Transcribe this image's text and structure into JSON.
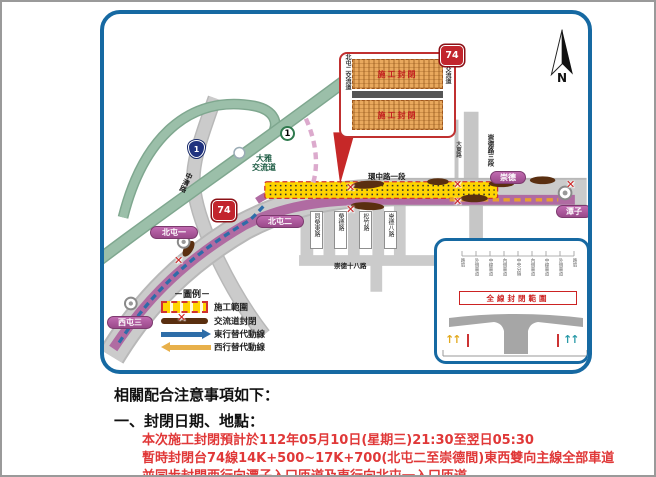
{
  "map": {
    "compass_label": "N",
    "callout": {
      "badge": "74",
      "left_road": "北屯二交流道",
      "right_road": "崇德交流道",
      "closure_label": "施工封閉"
    },
    "shields": {
      "expressway": "74",
      "provincial": "1",
      "national": "1"
    },
    "pills": {
      "beitun1": "北屯一",
      "beitun2": "北屯二",
      "xitun3": "西屯三",
      "chongde": "崇德",
      "tanzi": "潭子"
    },
    "labels": {
      "daya_interchange": [
        "大雅",
        "交流道"
      ],
      "huanzhong_rd": "環中路一段",
      "zhongqing_rd": "中清路",
      "dadong_rd": "大東路",
      "chongde_rd3": "崇德路三段",
      "streets": [
        "同榮東路",
        "榮德路",
        "松竹路",
        "崇德八路"
      ],
      "chongde18_rd": "崇德十八路"
    },
    "legend": {
      "title": "－圖例－",
      "items": [
        {
          "label": "施工範圍"
        },
        {
          "label": "交流道封閉"
        },
        {
          "label": "東行替代動線"
        },
        {
          "label": "西行替代動線"
        }
      ]
    },
    "inset": {
      "title": "全線封閉範圍",
      "lanes": [
        "路肩",
        "外側車道",
        "中線車道",
        "內側車道",
        "中央分隔",
        "內側車道",
        "中線車道",
        "外側車道",
        "路肩"
      ]
    }
  },
  "icons": {
    "closure_x": "✕",
    "up_arrows": "↑↑"
  },
  "notes": {
    "heading": "相關配合注意事項如下：",
    "item1_title": "一、封閉日期、地點：",
    "lines": [
      "本次施工封閉預計於112年05月10日(星期三)21:30至翌日05:30",
      "暫時封閉台74線14K+500~17K+700(北屯二至崇德間)東西雙向主線全部車道",
      "並同步封閉西行向潭子入口匝道及東行向北屯一入口匝道。"
    ]
  },
  "colors": {
    "map_border": "#1669a2",
    "road_gray": "#cbcbcb",
    "green_road": "#9bbfa9",
    "route_purple": "#b06ba2",
    "pill_purple": "#a94f97",
    "construction_yellow": "#ffd400",
    "ramp_brown": "#5a2f10",
    "closure_red": "#cc2222",
    "east_alt_blue": "#2e6da8",
    "west_alt_orange": "#e8a030",
    "note_red": "#e03838"
  }
}
